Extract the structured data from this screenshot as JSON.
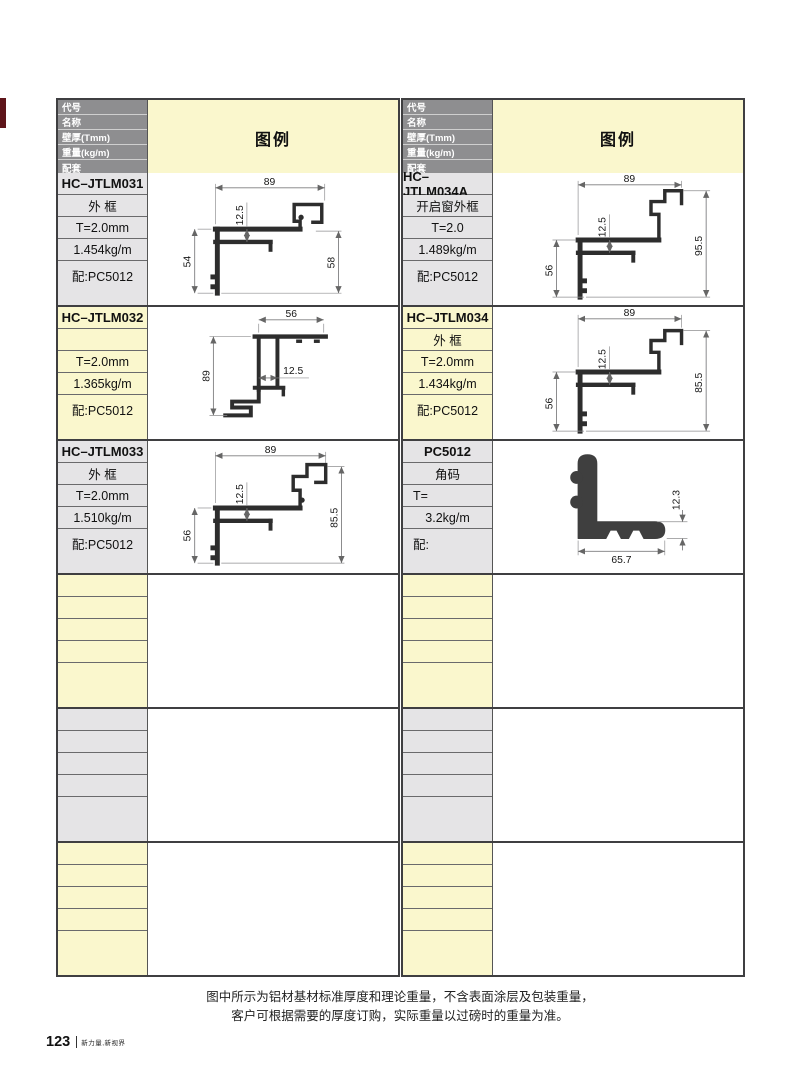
{
  "page": {
    "footer_note_line1": "图中所示为铝材基材标准厚度和理论重量，不含表面涂层及包装重量，",
    "footer_note_line2": "客户可根据需要的厚度订购，实际重量以过磅时的重量为准。",
    "page_number": "123",
    "page_footer_brand": "新力量,新视界"
  },
  "table": {
    "header_rows": [
      "代号",
      "名称",
      "壁厚(Tmm)",
      "重量(kg/m)",
      "配套"
    ],
    "legend_label": "图例"
  },
  "colors": {
    "header_gray": "#8e8e90",
    "cell_gray": "#e5e4e6",
    "cell_cream": "#faf7cd",
    "bleed_maroon": "#5e151a",
    "grid_line": "#3f3f41"
  },
  "products": [
    {
      "code": "HC–JTLM031",
      "name": "外 框",
      "thickness": "T=2.0mm",
      "weight": "1.454kg/m",
      "match": "配:PC5012",
      "dims": {
        "top": "89",
        "inner": "12.5",
        "left": "54",
        "right": "58"
      }
    },
    {
      "code": "HC–JTLM032",
      "name": "",
      "thickness": "T=2.0mm",
      "weight": "1.365kg/m",
      "match": "配:PC5012",
      "dims": {
        "top": "56",
        "inner": "12.5",
        "left": "89"
      }
    },
    {
      "code": "HC–JTLM033",
      "name": "外 框",
      "thickness": "T=2.0mm",
      "weight": "1.510kg/m",
      "match": "配:PC5012",
      "dims": {
        "top": "89",
        "inner": "12.5",
        "left": "56",
        "right": "85.5"
      }
    },
    {
      "code": "HC–JTLM034A",
      "name": "开启窗外框",
      "thickness": "T=2.0",
      "weight": "1.489kg/m",
      "match": "配:PC5012",
      "dims": {
        "top": "89",
        "inner": "12.5",
        "left": "56",
        "right": "95.5"
      }
    },
    {
      "code": "HC–JTLM034",
      "name": "外 框",
      "thickness": "T=2.0mm",
      "weight": "1.434kg/m",
      "match": "配:PC5012",
      "dims": {
        "top": "89",
        "inner": "12.5",
        "left": "56",
        "right": "85.5"
      }
    },
    {
      "code": "PC5012",
      "name": "角码",
      "thickness": "T=",
      "weight": "3.2kg/m",
      "match": "配:",
      "dims": {
        "bottom": "65.7",
        "right": "12.3"
      }
    }
  ]
}
